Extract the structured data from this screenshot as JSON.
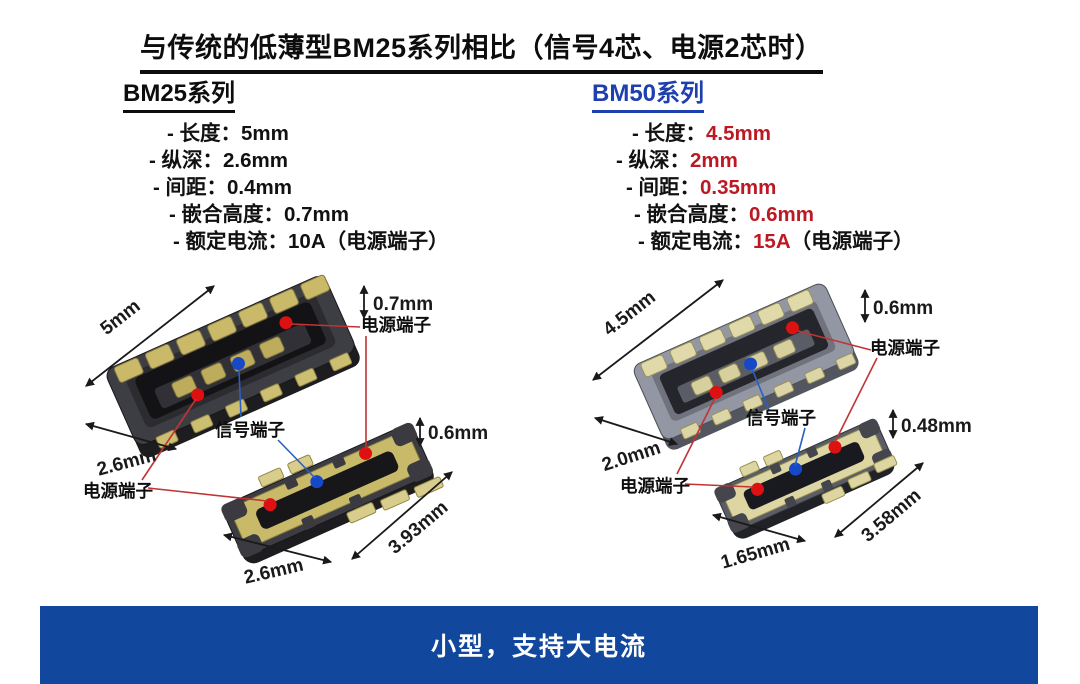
{
  "title": {
    "text": "与传统的低薄型BM25系列相比（信号4芯、电源2芯时）"
  },
  "bm25": {
    "heading": "BM25系列",
    "specs": [
      {
        "label": "- 长度：",
        "value": "5mm",
        "suffix": ""
      },
      {
        "label": "- 纵深：",
        "value": "2.6mm",
        "suffix": ""
      },
      {
        "label": "- 间距：",
        "value": "0.4mm",
        "suffix": ""
      },
      {
        "label": "- 嵌合高度：",
        "value": "0.7mm",
        "suffix": ""
      },
      {
        "label": "- 额定电流：",
        "value": "10A",
        "suffix": "（电源端子）"
      }
    ]
  },
  "bm50": {
    "heading": "BM50系列",
    "specs": [
      {
        "label": "- 长度：",
        "value": "4.5mm",
        "suffix": ""
      },
      {
        "label": "- 纵深：",
        "value": "2mm",
        "suffix": ""
      },
      {
        "label": "- 间距：",
        "value": "0.35mm",
        "suffix": ""
      },
      {
        "label": "- 嵌合高度：",
        "value": "0.6mm",
        "suffix": ""
      },
      {
        "label": "- 额定电流：",
        "value": "15A",
        "suffix": "（电源端子）"
      }
    ]
  },
  "diagram_bm25": {
    "top": {
      "length": "5mm",
      "height": "0.7mm",
      "depth": "2.6mm"
    },
    "bottom": {
      "height": "0.6mm",
      "length": "3.93mm",
      "width": "2.6mm"
    },
    "labels": {
      "power_top": "电源端子",
      "signal": "信号端子",
      "power_bottom": "电源端子"
    }
  },
  "diagram_bm50": {
    "top": {
      "length": "4.5mm",
      "height": "0.6mm",
      "depth": "2.0mm"
    },
    "bottom": {
      "height": "0.48mm",
      "length": "3.58mm",
      "width": "1.65mm"
    },
    "labels": {
      "power_top": "电源端子",
      "signal": "信号端子",
      "power_bottom": "电源端子"
    }
  },
  "footer": {
    "text": "小型，支持大电流"
  },
  "colors": {
    "series_blue": "#1e3fae",
    "highlight_red": "#bb1a24",
    "footer_bg": "#11479d",
    "annotation_red": "#c03434",
    "annotation_blue": "#2a5fc4",
    "power_dot_red": "#dd1111",
    "signal_dot_blue": "#1648c8"
  }
}
